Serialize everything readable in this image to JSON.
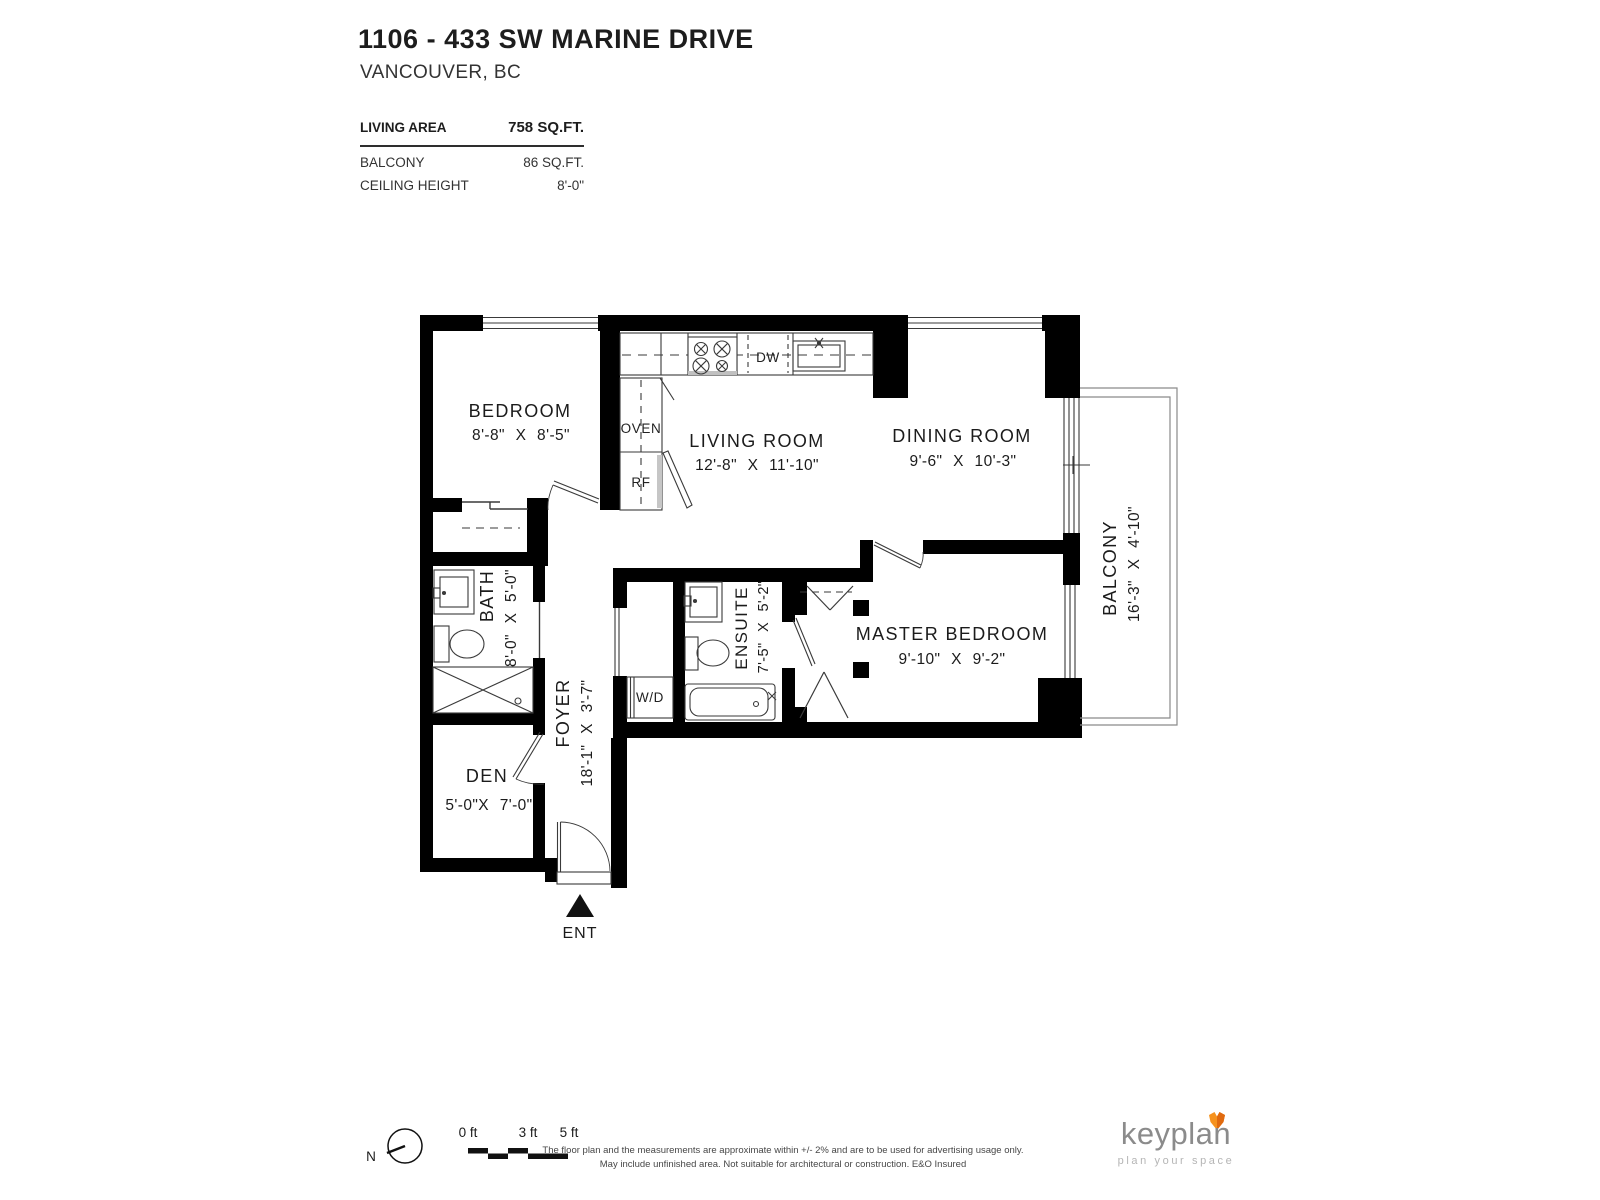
{
  "header": {
    "address": "1106 - 433 SW MARINE DRIVE",
    "city": "VANCOUVER, BC"
  },
  "stats": {
    "living_label": "LIVING AREA",
    "living_value": "758 SQ.FT.",
    "balcony_label": "BALCONY",
    "balcony_value": "86 SQ.FT.",
    "ceiling_label": "CEILING HEIGHT",
    "ceiling_value": "8'-0\""
  },
  "rooms": {
    "bedroom": {
      "name": "BEDROOM",
      "dims": "8'-8\" X 8'-5\""
    },
    "living": {
      "name": "LIVING ROOM",
      "dims": "12'-8\" X 11'-10\""
    },
    "dining": {
      "name": "DINING ROOM",
      "dims": "9'-6\" X 10'-3\""
    },
    "master": {
      "name": "MASTER BEDROOM",
      "dims": "9'-10\" X 9'-2\""
    },
    "balcony": {
      "name": "BALCONY",
      "dims": "16'-3\" X 4'-10\""
    },
    "bath": {
      "name": "BATH",
      "dims": "8'-0\" X 5'-0\""
    },
    "ensuite": {
      "name": "ENSUITE",
      "dims": "7'-5\" X 5'-2\""
    },
    "foyer": {
      "name": "FOYER",
      "dims": "18'-1\" X 3'-7\""
    },
    "den": {
      "name": "DEN",
      "dims": "5'-0\"X 7'-0\""
    }
  },
  "labels": {
    "oven": "OVEN",
    "fridge": "RF",
    "dishwasher": "DW",
    "washer_dryer": "W/D",
    "entrance": "ENT"
  },
  "scale": {
    "zero": "0 ft",
    "three": "3 ft",
    "five": "5 ft",
    "north": "N"
  },
  "footer": {
    "disclaimer1": "The floor plan and the measurements are approximate within +/- 2% and are to be used for advertising usage only.",
    "disclaimer2": "May include unfinished area. Not suitable for architectural or construction. E&O Insured",
    "brand": "keyplan",
    "tagline": "plan your space"
  },
  "colors": {
    "wall": "#000000",
    "line": "#3a3a3a",
    "fox_orange": "#F6921E",
    "fox_shade": "#E06A10",
    "brand_gray": "#8B8B8B",
    "tagline_gray": "#B5B5B5"
  }
}
